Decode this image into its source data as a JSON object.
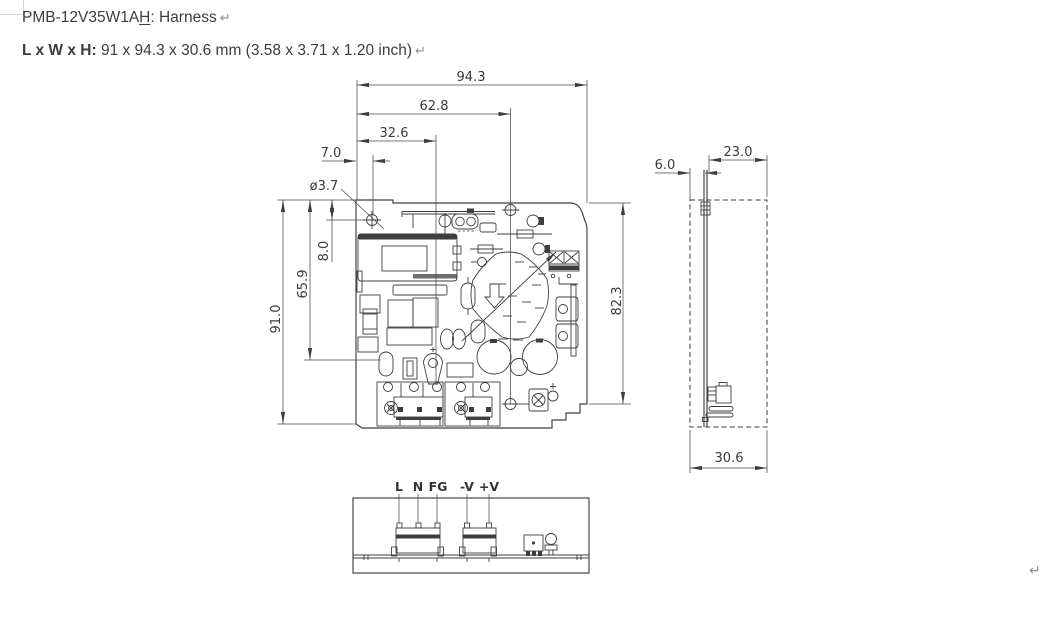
{
  "document": {
    "title": {
      "model_prefix": "PMB-12V35W1A",
      "model_suffix_underlined": "H",
      "descriptor": ": Harness"
    },
    "size_line": {
      "label": "L x W x H:",
      "value": " 91 x 94.3 x 30.6 mm (3.58 x 3.71 x 1.20 inch)"
    },
    "return_mark": "↵"
  },
  "drawing": {
    "top_view_dims": {
      "width_total": "94.3",
      "width_62_8": "62.8",
      "width_32_6": "32.6",
      "edge_to_hole": "7.0",
      "hole_diameter": "ø3.7",
      "top_to_hole": "8.0",
      "height_65_9": "65.9",
      "height_total": "91.0",
      "height_right": "82.3"
    },
    "side_view_dims": {
      "below_board": "6.0",
      "component_height": "23.0",
      "depth_total": "30.6"
    },
    "front_view_terminals": [
      "L",
      "N",
      "FG",
      "-V",
      "+V"
    ]
  },
  "colors": {
    "line": "#3e3e3e",
    "dim_text": "#3a3a3a",
    "formatting_mark": "#8f8f8f"
  }
}
